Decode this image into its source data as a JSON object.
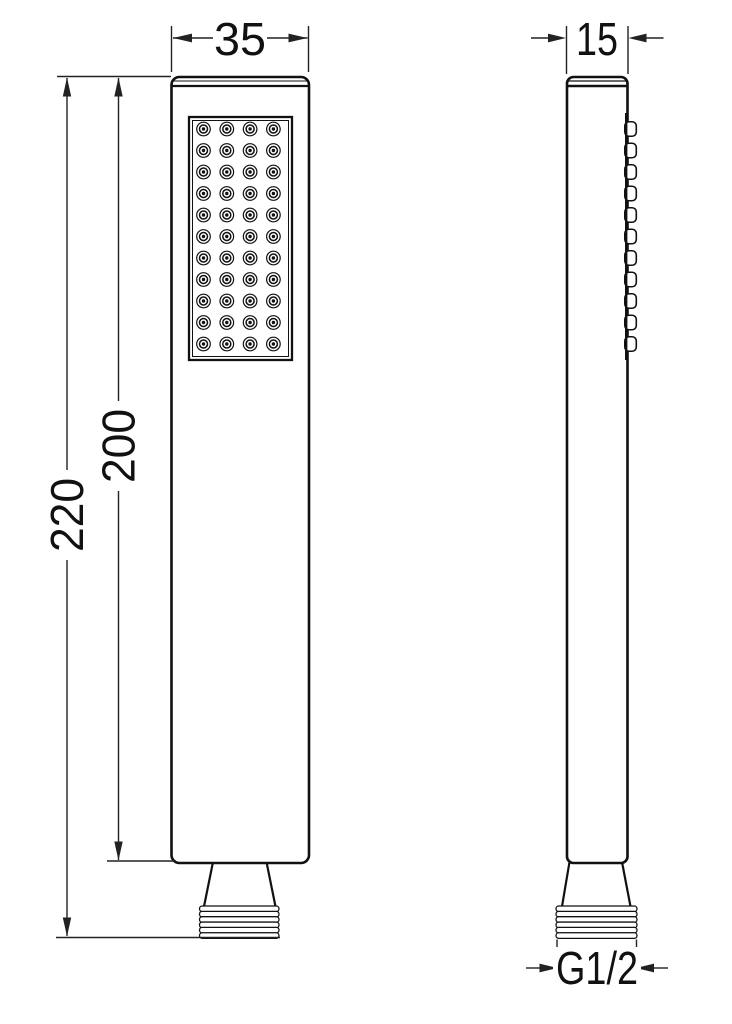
{
  "drawing": {
    "type": "technical-dimension-drawing",
    "subject": "hand-shower",
    "colors": {
      "line": "#111111",
      "dim": "#222222",
      "background": "#ffffff"
    },
    "dimensions": {
      "front_width": "35",
      "side_depth": "15",
      "total_height": "220",
      "body_height": "200",
      "thread_size": "G1/2"
    },
    "nozzles": {
      "rows": 11,
      "columns": 4
    },
    "threads": {
      "ridges": 6
    },
    "side_bumps": {
      "count": 11
    }
  }
}
